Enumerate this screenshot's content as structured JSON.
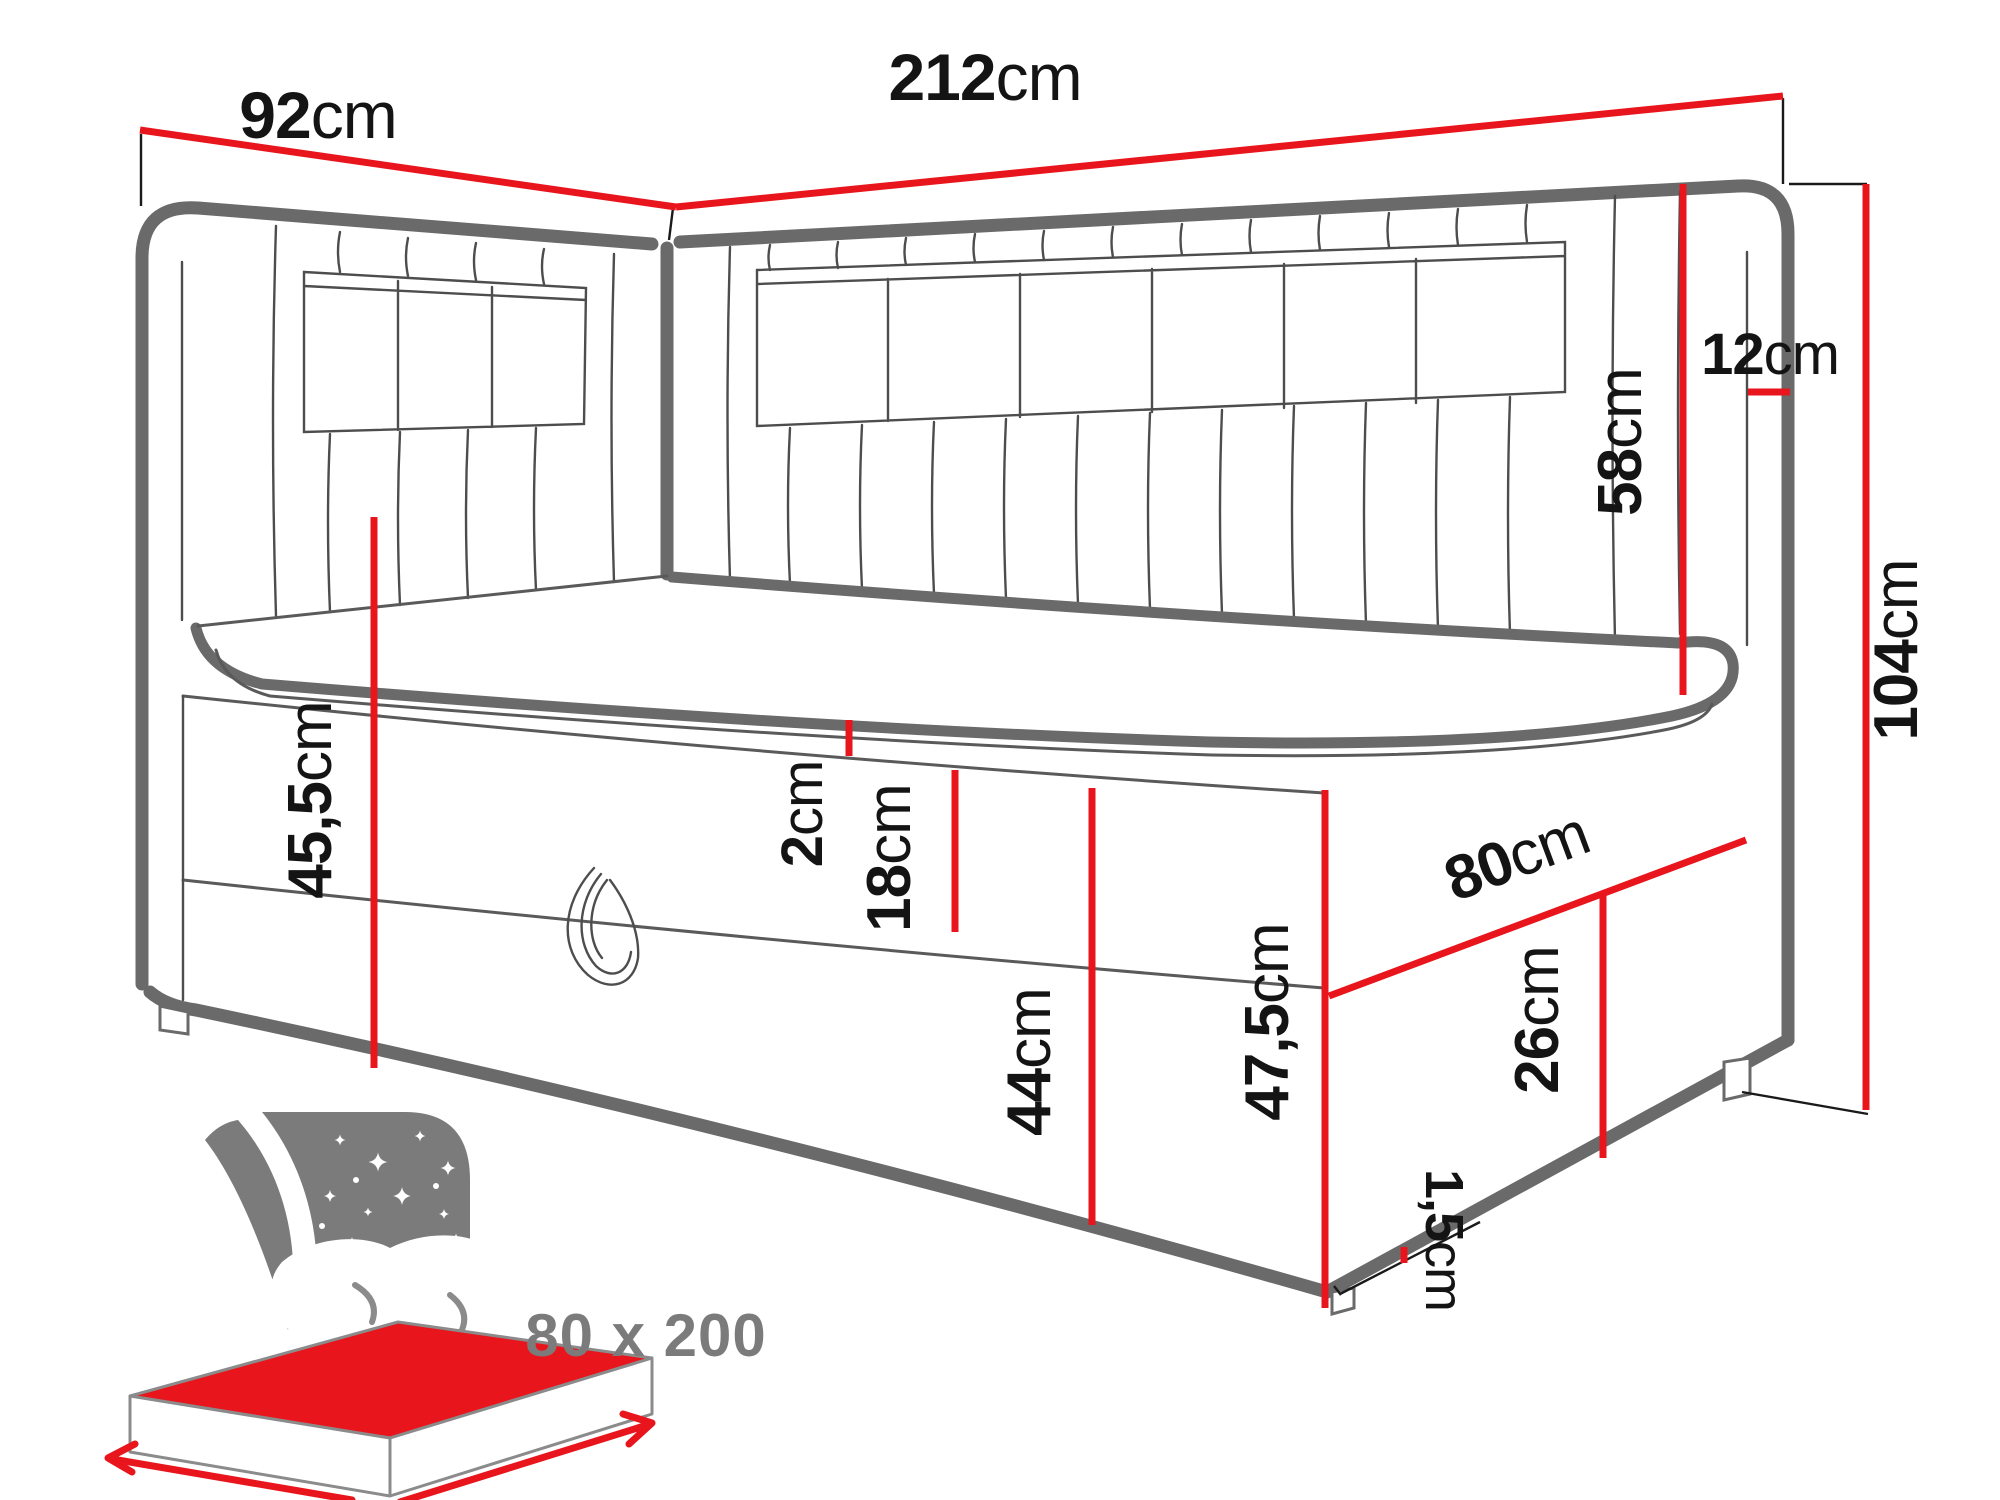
{
  "dims": {
    "d92": {
      "name": "headboard-side-width",
      "value": "92",
      "unit": "cm"
    },
    "d212": {
      "name": "bed-total-length",
      "value": "212",
      "unit": "cm"
    },
    "d12": {
      "name": "headboard-panel-thickness",
      "value": "12",
      "unit": "cm"
    },
    "d58": {
      "name": "headboard-above-mattress",
      "value": "58",
      "unit": "cm"
    },
    "d104": {
      "name": "total-height",
      "value": "104",
      "unit": "cm"
    },
    "d2": {
      "name": "topper-thickness",
      "value": "2",
      "unit": "cm"
    },
    "d18": {
      "name": "mattress-height",
      "value": "18",
      "unit": "cm"
    },
    "d455": {
      "name": "seat-height",
      "value": "45,5",
      "unit": "cm"
    },
    "d44": {
      "name": "drawer-front-height",
      "value": "44",
      "unit": "cm"
    },
    "d80": {
      "name": "bed-front-width",
      "value": "80",
      "unit": "cm"
    },
    "d26": {
      "name": "base-side-height",
      "value": "26",
      "unit": "cm"
    },
    "d475": {
      "name": "base-total-height",
      "value": "47,5",
      "unit": "cm"
    },
    "d15": {
      "name": "bottom-clearance",
      "value": "1,5",
      "unit": "cm"
    }
  },
  "badge": {
    "label": "80 x 200"
  },
  "colors": {
    "dimension": "#e8151d",
    "outline": "#6a6a6a",
    "badge_gray": "#7b7b7b",
    "text": "#141414"
  }
}
